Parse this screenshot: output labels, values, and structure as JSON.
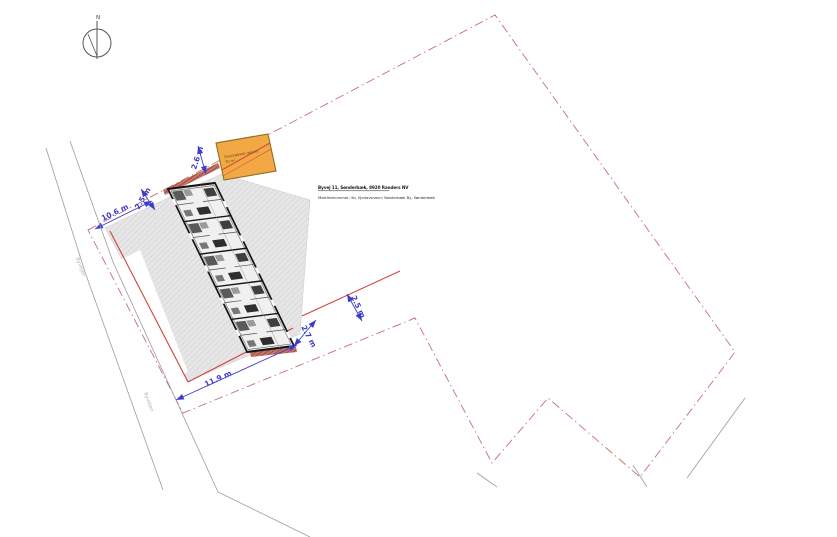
{
  "north": {
    "label": "N"
  },
  "address": {
    "line1": "Byvej 11, Sønderbæk, 8920 Randers NV",
    "line2": "Matrikelnummer: 5b, Ejerlavsnavn: Sønderbæk By, Sønderbæk"
  },
  "garage": {
    "line1": "Overdækket carport",
    "line2": "30 m²"
  },
  "roads": {
    "label_upper": "Byvejen",
    "label_lower": "Byvejen"
  },
  "dimensions": {
    "top_left_offset": "2.5 m",
    "top_left_length": "10.6 m",
    "garage_offset": "2.6 m",
    "bottom_length": "11.9 m",
    "bottom_offset": "2.7 m",
    "right_offset": "2.5 m"
  },
  "colors": {
    "boundary_dashdot": "#c87070",
    "offset_line_red": "#d24040",
    "dimension_blue": "#3c3ccd",
    "garage_fill": "#f2a844",
    "pavement_gray": "#e6e6e6",
    "hedge_red": "#8d2f23"
  }
}
